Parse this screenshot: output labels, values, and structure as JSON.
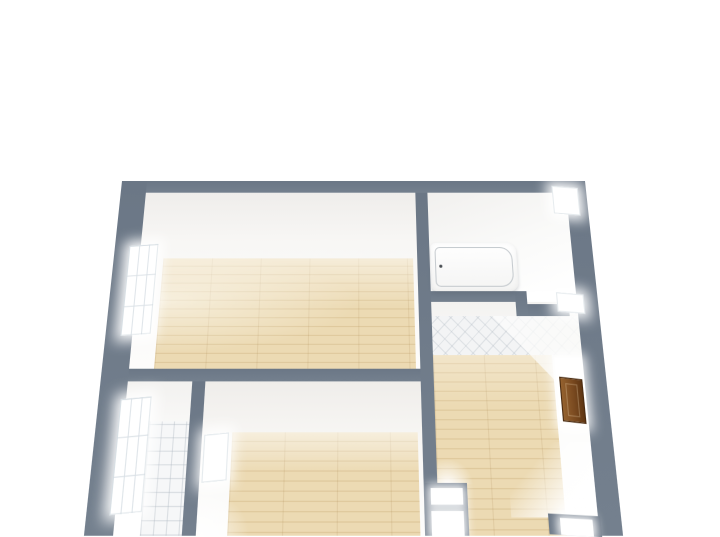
{
  "scene": {
    "kind": "3d-floor-plan-render",
    "view": "top-down-perspective",
    "background": "#ffffff"
  },
  "colors": {
    "wall": "#6b7786",
    "wall_light": "#74808e",
    "wall_face": "#f5f4f2",
    "wood_floor": "#e9d6ad",
    "wood_seam": "#dfc99d",
    "tile": "#f6f7f8",
    "tile_line": "#a8b2bc",
    "door_brown": "#7a4a20",
    "window_glow": "#ffffff"
  },
  "rooms": [
    {
      "id": "living",
      "label": "Living room",
      "floor": "wood"
    },
    {
      "id": "bathroom",
      "label": "Bathroom",
      "floor": "white"
    },
    {
      "id": "wc",
      "label": "WC / toilet room",
      "floor": "diagonal-tile"
    },
    {
      "id": "hallway",
      "label": "Hallway",
      "floor": "wood"
    },
    {
      "id": "bedroom",
      "label": "Bedroom",
      "floor": "wood"
    },
    {
      "id": "balcony",
      "label": "Balcony",
      "floor": "square-tile"
    }
  ],
  "objects": [
    {
      "name": "bathtub",
      "room": "bathroom"
    },
    {
      "name": "entrance-door",
      "room": "hallway",
      "color": "#7a4a20"
    },
    {
      "name": "window-living-west",
      "room": "living"
    },
    {
      "name": "window-balcony-west",
      "room": "balcony"
    },
    {
      "name": "window-bedroom-balcony",
      "room": "bedroom"
    },
    {
      "name": "window-bathroom-east",
      "room": "bathroom"
    },
    {
      "name": "window-wc-east",
      "room": "wc"
    },
    {
      "name": "doorway-opening-upper",
      "room": "hallway"
    },
    {
      "name": "doorway-opening-lower",
      "room": "hallway"
    },
    {
      "name": "doorway-opening-south",
      "room": "hallway"
    }
  ]
}
